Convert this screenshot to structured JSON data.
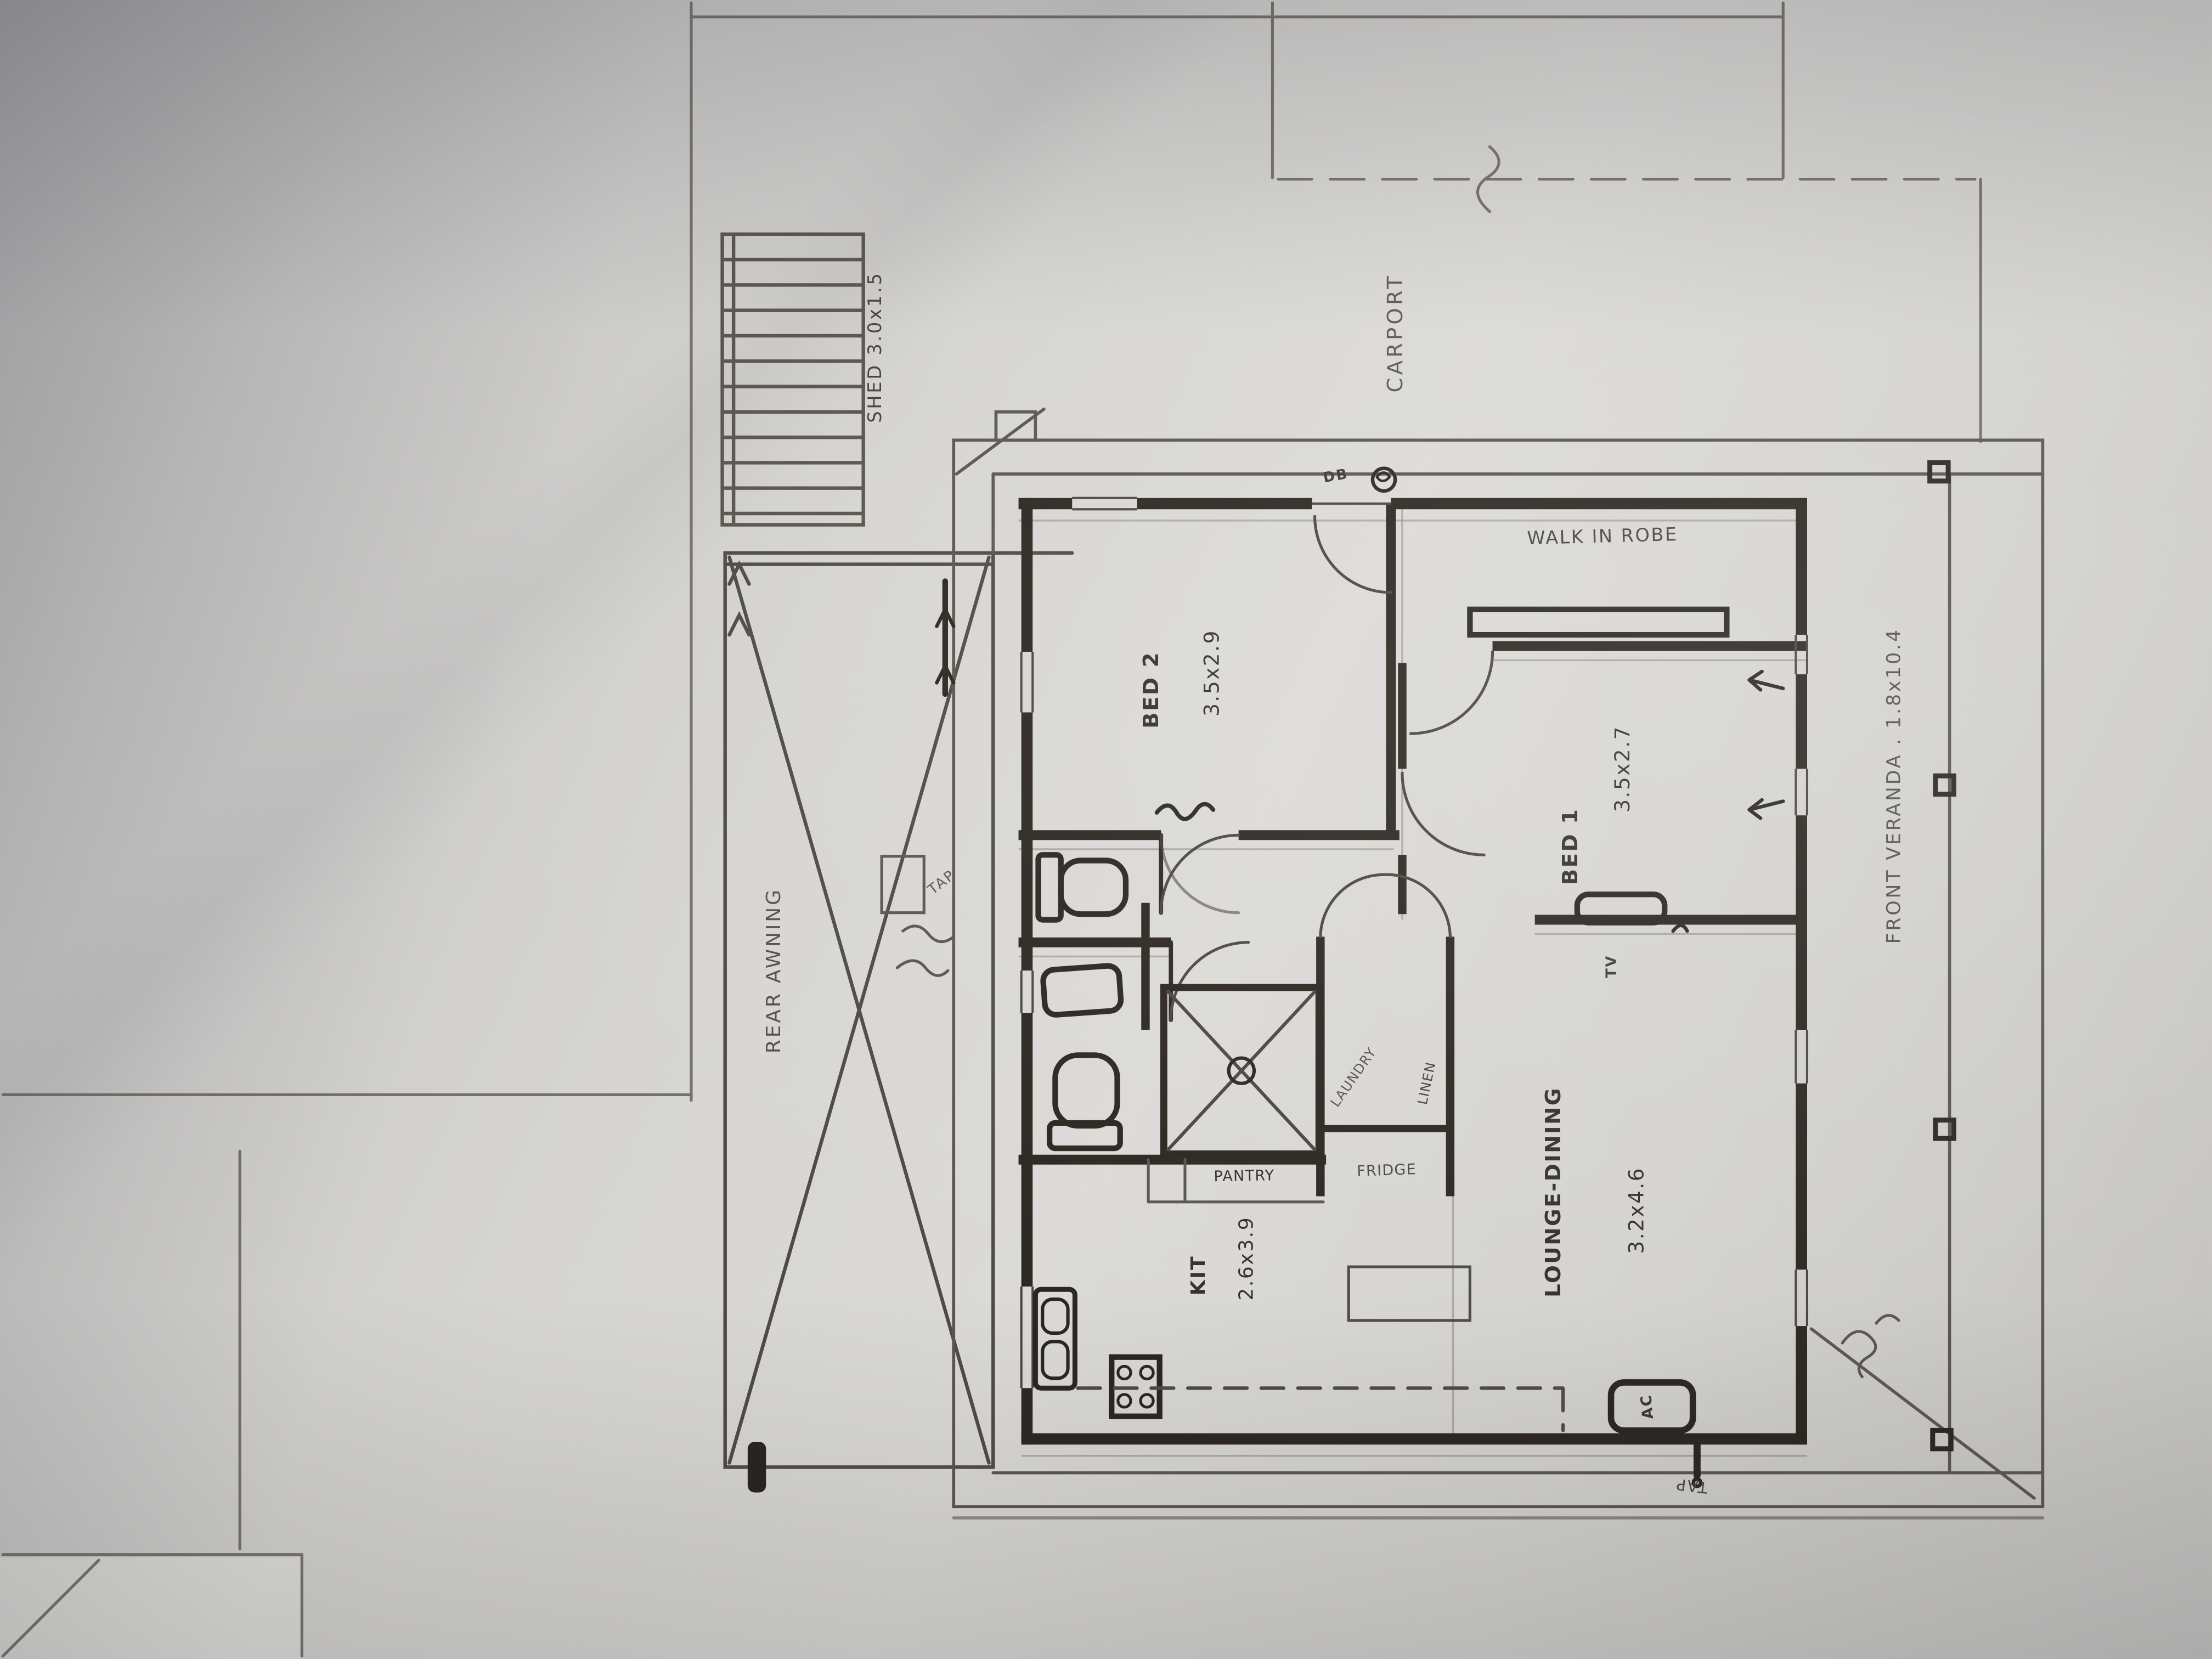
{
  "document_type": "hand-drawn house floor plan sketch (pencil and pen on paper)",
  "colors": {
    "paper": "#d6d5d2",
    "pencil": "#6d6660",
    "pencil_dark": "#4e4943",
    "ink": "#2b2620"
  },
  "areas": {
    "shed": {
      "label": "SHED",
      "dims": "3.0x1.5",
      "text": "SHED 3.0x1.5"
    },
    "carport": {
      "label": "CARPORT"
    },
    "rear_awning": {
      "label": "REAR AWNING"
    },
    "front_veranda": {
      "label": "FRONT VERANDA",
      "dims": "1.8x10.4",
      "text": "FRONT VERANDA . 1.8x10.4"
    },
    "bed2": {
      "label": "BED 2",
      "dims": "3.5x2.9"
    },
    "bed1": {
      "label": "BED 1",
      "dims": "3.5x2.7"
    },
    "walk_in_robe": {
      "label": "WALK IN ROBE"
    },
    "lounge_dining": {
      "label": "LOUNGE-DINING",
      "dims": "3.2x4.6"
    },
    "kitchen": {
      "label": "KIT",
      "dims": "2.6x3.9"
    },
    "pantry": {
      "label": "PANTRY"
    },
    "fridge": {
      "label": "FRIDGE"
    },
    "linen": {
      "label": "LINEN"
    },
    "laundry": {
      "label": "LAUNDRY"
    }
  },
  "annotations": {
    "db": "DB",
    "tv": "TV",
    "ac": "AC",
    "tap_side": "TAP",
    "tap_bottom": "TAP"
  }
}
